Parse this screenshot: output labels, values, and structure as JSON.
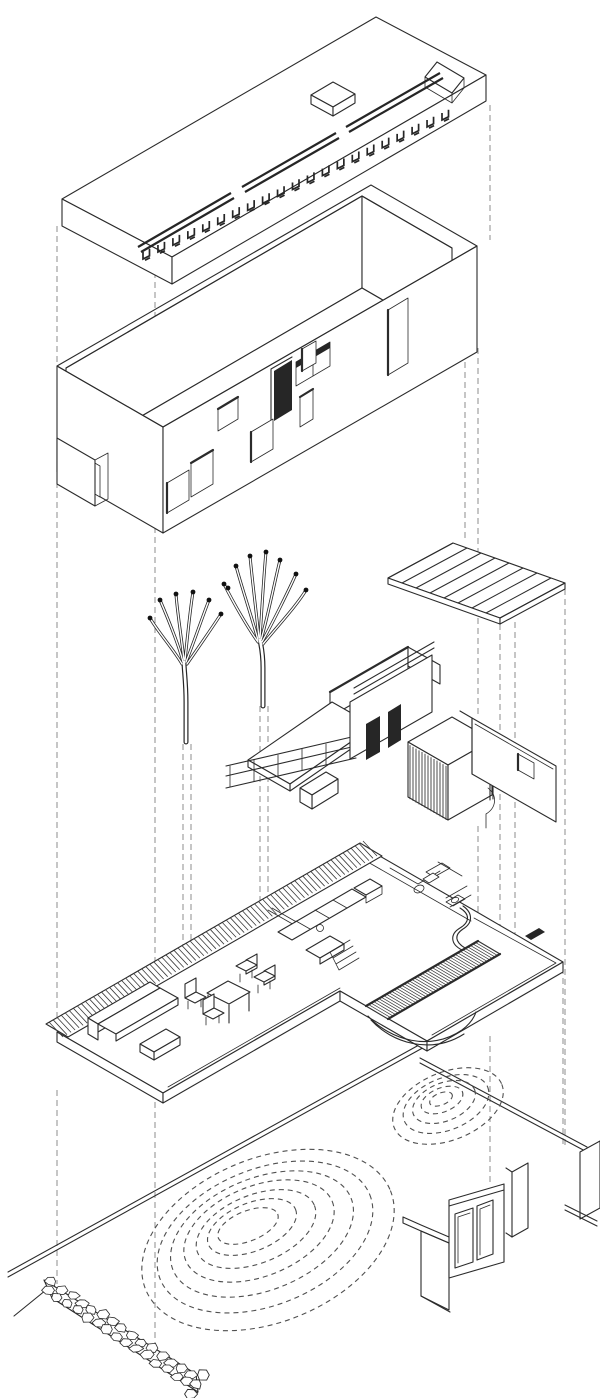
{
  "document": {
    "title": "Exploded axonometric drawing of a single-storey house",
    "medium": "Black ink line drawing on white paper"
  },
  "palette": {
    "paper": "#ffffff",
    "line": "#2b2b2b",
    "dark_fill": "#262626",
    "hatch": "#3a3a3a",
    "contour": "#4f4f4f",
    "projection": "#8c8c8c"
  },
  "layers": [
    {
      "id": "projection-lines",
      "label": "Vertical dashed projection lines linking the exploded layers"
    },
    {
      "id": "site-layer",
      "label": "Ground plane with dashed contour mounds, rubble stone wall and gate walls"
    },
    {
      "id": "floorplan-layer",
      "label": "Furnished floor plan with sofa, dining set, kitchen, bath, timber deck and terrace"
    },
    {
      "id": "interior-layer",
      "label": "Interior partitions, stair railing, hatched bath volume and curved wall"
    },
    {
      "id": "trees",
      "label": "Two leafless trees with black branch tips"
    },
    {
      "id": "canopy-layer",
      "label": "Slatted canopy panel"
    },
    {
      "id": "shell-layer",
      "label": "Open-top building shell with door and window openings"
    },
    {
      "id": "roof-layer",
      "label": "Roof slab with skylight box, joist strip and corner notch"
    }
  ],
  "generated": {
    "joist_count": 21,
    "canopy_slat_count": 9,
    "deck_plank_count": 44,
    "edge_hatch_count": 78,
    "large_contour_rings": 7,
    "small_contour_rings": 5,
    "stone_rows": 2,
    "stone_cols": 15,
    "bath_hatch_step": 3
  }
}
